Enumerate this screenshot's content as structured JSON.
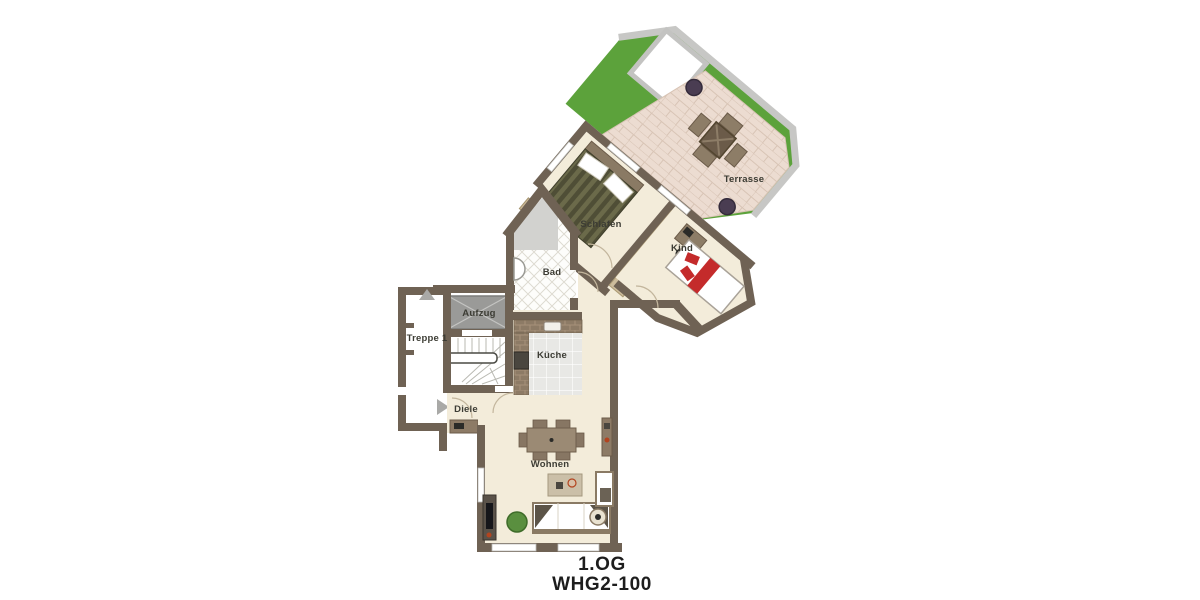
{
  "title": {
    "line1": "1.OG",
    "line2": "WHG2-100"
  },
  "rooms": {
    "terrasse": "Terrasse",
    "schlafen": "Schlafen",
    "kind": "Kind",
    "bad": "Bad",
    "aufzug": "Aufzug",
    "treppe": "Treppe 1",
    "kueche": "Küche",
    "diele": "Diele",
    "wohnen": "Wohnen"
  },
  "icons": {
    "stair_up_arrow": "up-triangle",
    "entrance_arrow": "right-triangle"
  },
  "colors": {
    "wall_brown": "#6f6254",
    "wall_gray": "#c7c7c5",
    "floor_cream": "#f3ecda",
    "grass_green": "#5ca23b",
    "terrace_tile": "#ecdcd1",
    "kitchen_tile": "#e8e8e5",
    "accent_red": "#c42b2b",
    "furniture_brown": "#9b8a74",
    "bed_olive": "#6b6a4a"
  }
}
